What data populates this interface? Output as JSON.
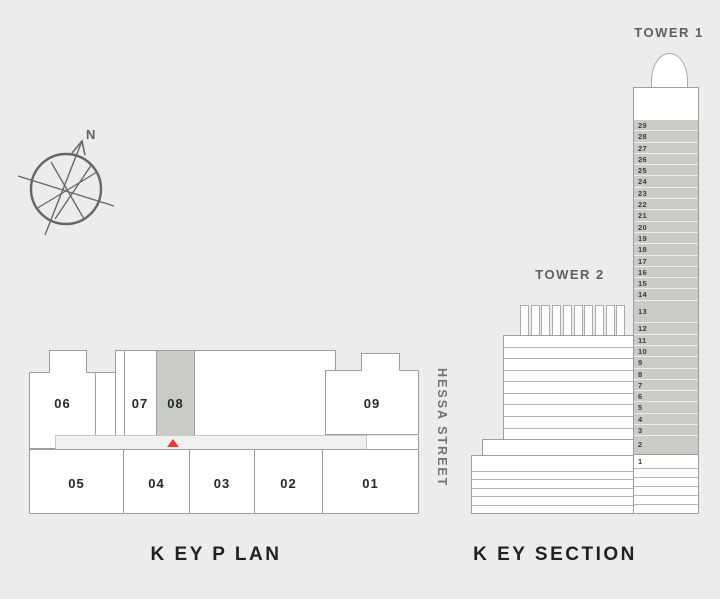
{
  "colors": {
    "background": "#ebeceb",
    "block_fill": "#fefefe",
    "outline": "#9b9e9a",
    "highlight_gray": "#c9cbc6",
    "marker_red": "#e93a42",
    "title_text": "#1f2225",
    "tower_label_text": "#5c605e",
    "street_text": "#70736f"
  },
  "compass": {
    "north_label": "N"
  },
  "key_plan": {
    "title": "K EY P LAN",
    "street_label": "HESSA STREET",
    "upper_units": [
      {
        "id": "06",
        "highlighted": false
      },
      {
        "id": "07",
        "highlighted": false
      },
      {
        "id": "08",
        "highlighted": true
      },
      {
        "id": "09",
        "highlighted": false
      }
    ],
    "lower_units": [
      {
        "id": "05",
        "highlighted": false
      },
      {
        "id": "04",
        "highlighted": false
      },
      {
        "id": "03",
        "highlighted": false
      },
      {
        "id": "02",
        "highlighted": false
      },
      {
        "id": "01",
        "highlighted": false
      }
    ]
  },
  "key_section": {
    "title": "K EY SECTION",
    "tower1": {
      "label": "TOWER 1",
      "floors": [
        "29",
        "28",
        "27",
        "26",
        "25",
        "24",
        "23",
        "22",
        "21",
        "20",
        "19",
        "18",
        "17",
        "16",
        "15",
        "14",
        "13",
        "12",
        "11",
        "10",
        "9",
        "8",
        "7",
        "6",
        "5",
        "4",
        "3",
        "2"
      ],
      "ground_floor": "1"
    },
    "tower2": {
      "label": "TOWER 2"
    }
  }
}
